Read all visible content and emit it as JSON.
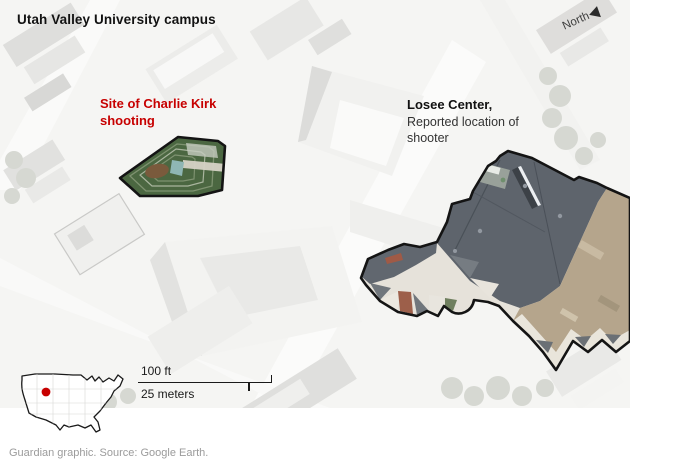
{
  "map": {
    "title": "Utah Valley University campus",
    "north_label": "North",
    "annotations": {
      "shooting_site": "Site of Charlie Kirk shooting",
      "losee_title": "Losee Center,",
      "losee_subtitle": "Reported location of shooter"
    },
    "scale_bar": {
      "feet_label": "100 ft",
      "meters_label": "25 meters"
    },
    "inset": {
      "icon": "us-locator-map",
      "marker_icon": "location-dot",
      "marker_color": "#c70000"
    },
    "colors": {
      "accent_red": "#c70000",
      "courtyard_green": "#4b6741",
      "roof_slate": "#5e646c",
      "roof_tan": "#b5a58c",
      "outline_black": "#141414",
      "caption_gray": "#9b9b9b"
    }
  },
  "caption": "Guardian graphic. Source: Google Earth."
}
